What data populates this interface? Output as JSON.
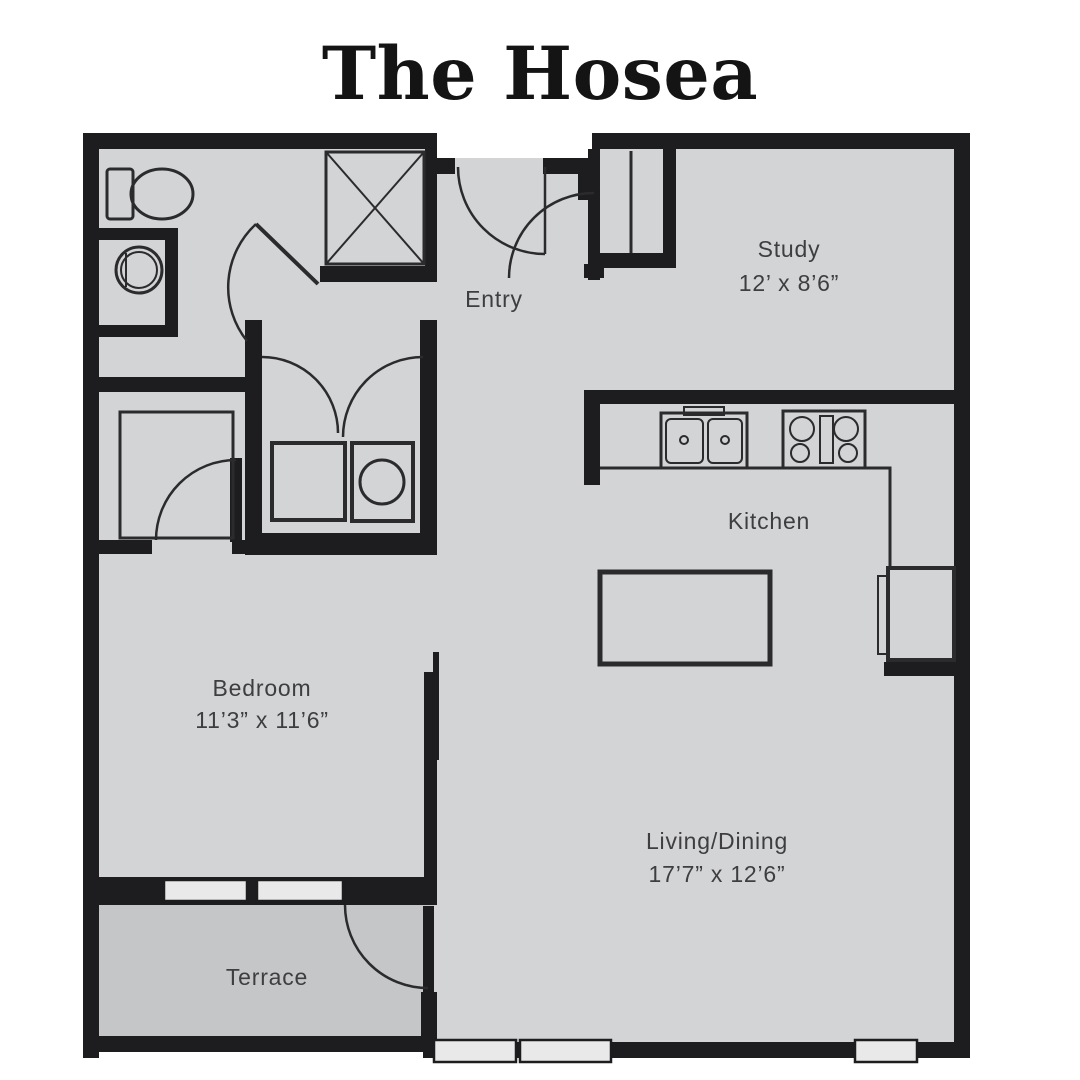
{
  "title": "The Hosea",
  "colors": {
    "wall": "#1d1d1f",
    "line": "#2b2b2d",
    "floor": "#d3d4d6",
    "terrace": "#c5c6c8",
    "window": "#e9e9ea",
    "label": "#3e3e40"
  },
  "rooms": [
    {
      "id": "entry",
      "name": "Entry",
      "dims": ""
    },
    {
      "id": "study",
      "name": "Study",
      "dims": "12’ x 8’6”"
    },
    {
      "id": "kitchen",
      "name": "Kitchen",
      "dims": ""
    },
    {
      "id": "bedroom",
      "name": "Bedroom",
      "dims": "11’3” x 11’6”"
    },
    {
      "id": "living",
      "name": "Living/Dining",
      "dims": "17’7” x 12’6”"
    },
    {
      "id": "terrace",
      "name": "Terrace",
      "dims": ""
    }
  ],
  "fixtures": [
    "toilet",
    "bathroom-sink",
    "shower",
    "washer",
    "dryer",
    "kitchen-sink",
    "stove",
    "refrigerator",
    "kitchen-island",
    "entry-door",
    "study-door",
    "bathroom-door",
    "bedroom-door",
    "closet-double-doors",
    "sliding-door",
    "terrace-door",
    "entry-closet",
    "bedroom-closet",
    "windows"
  ]
}
